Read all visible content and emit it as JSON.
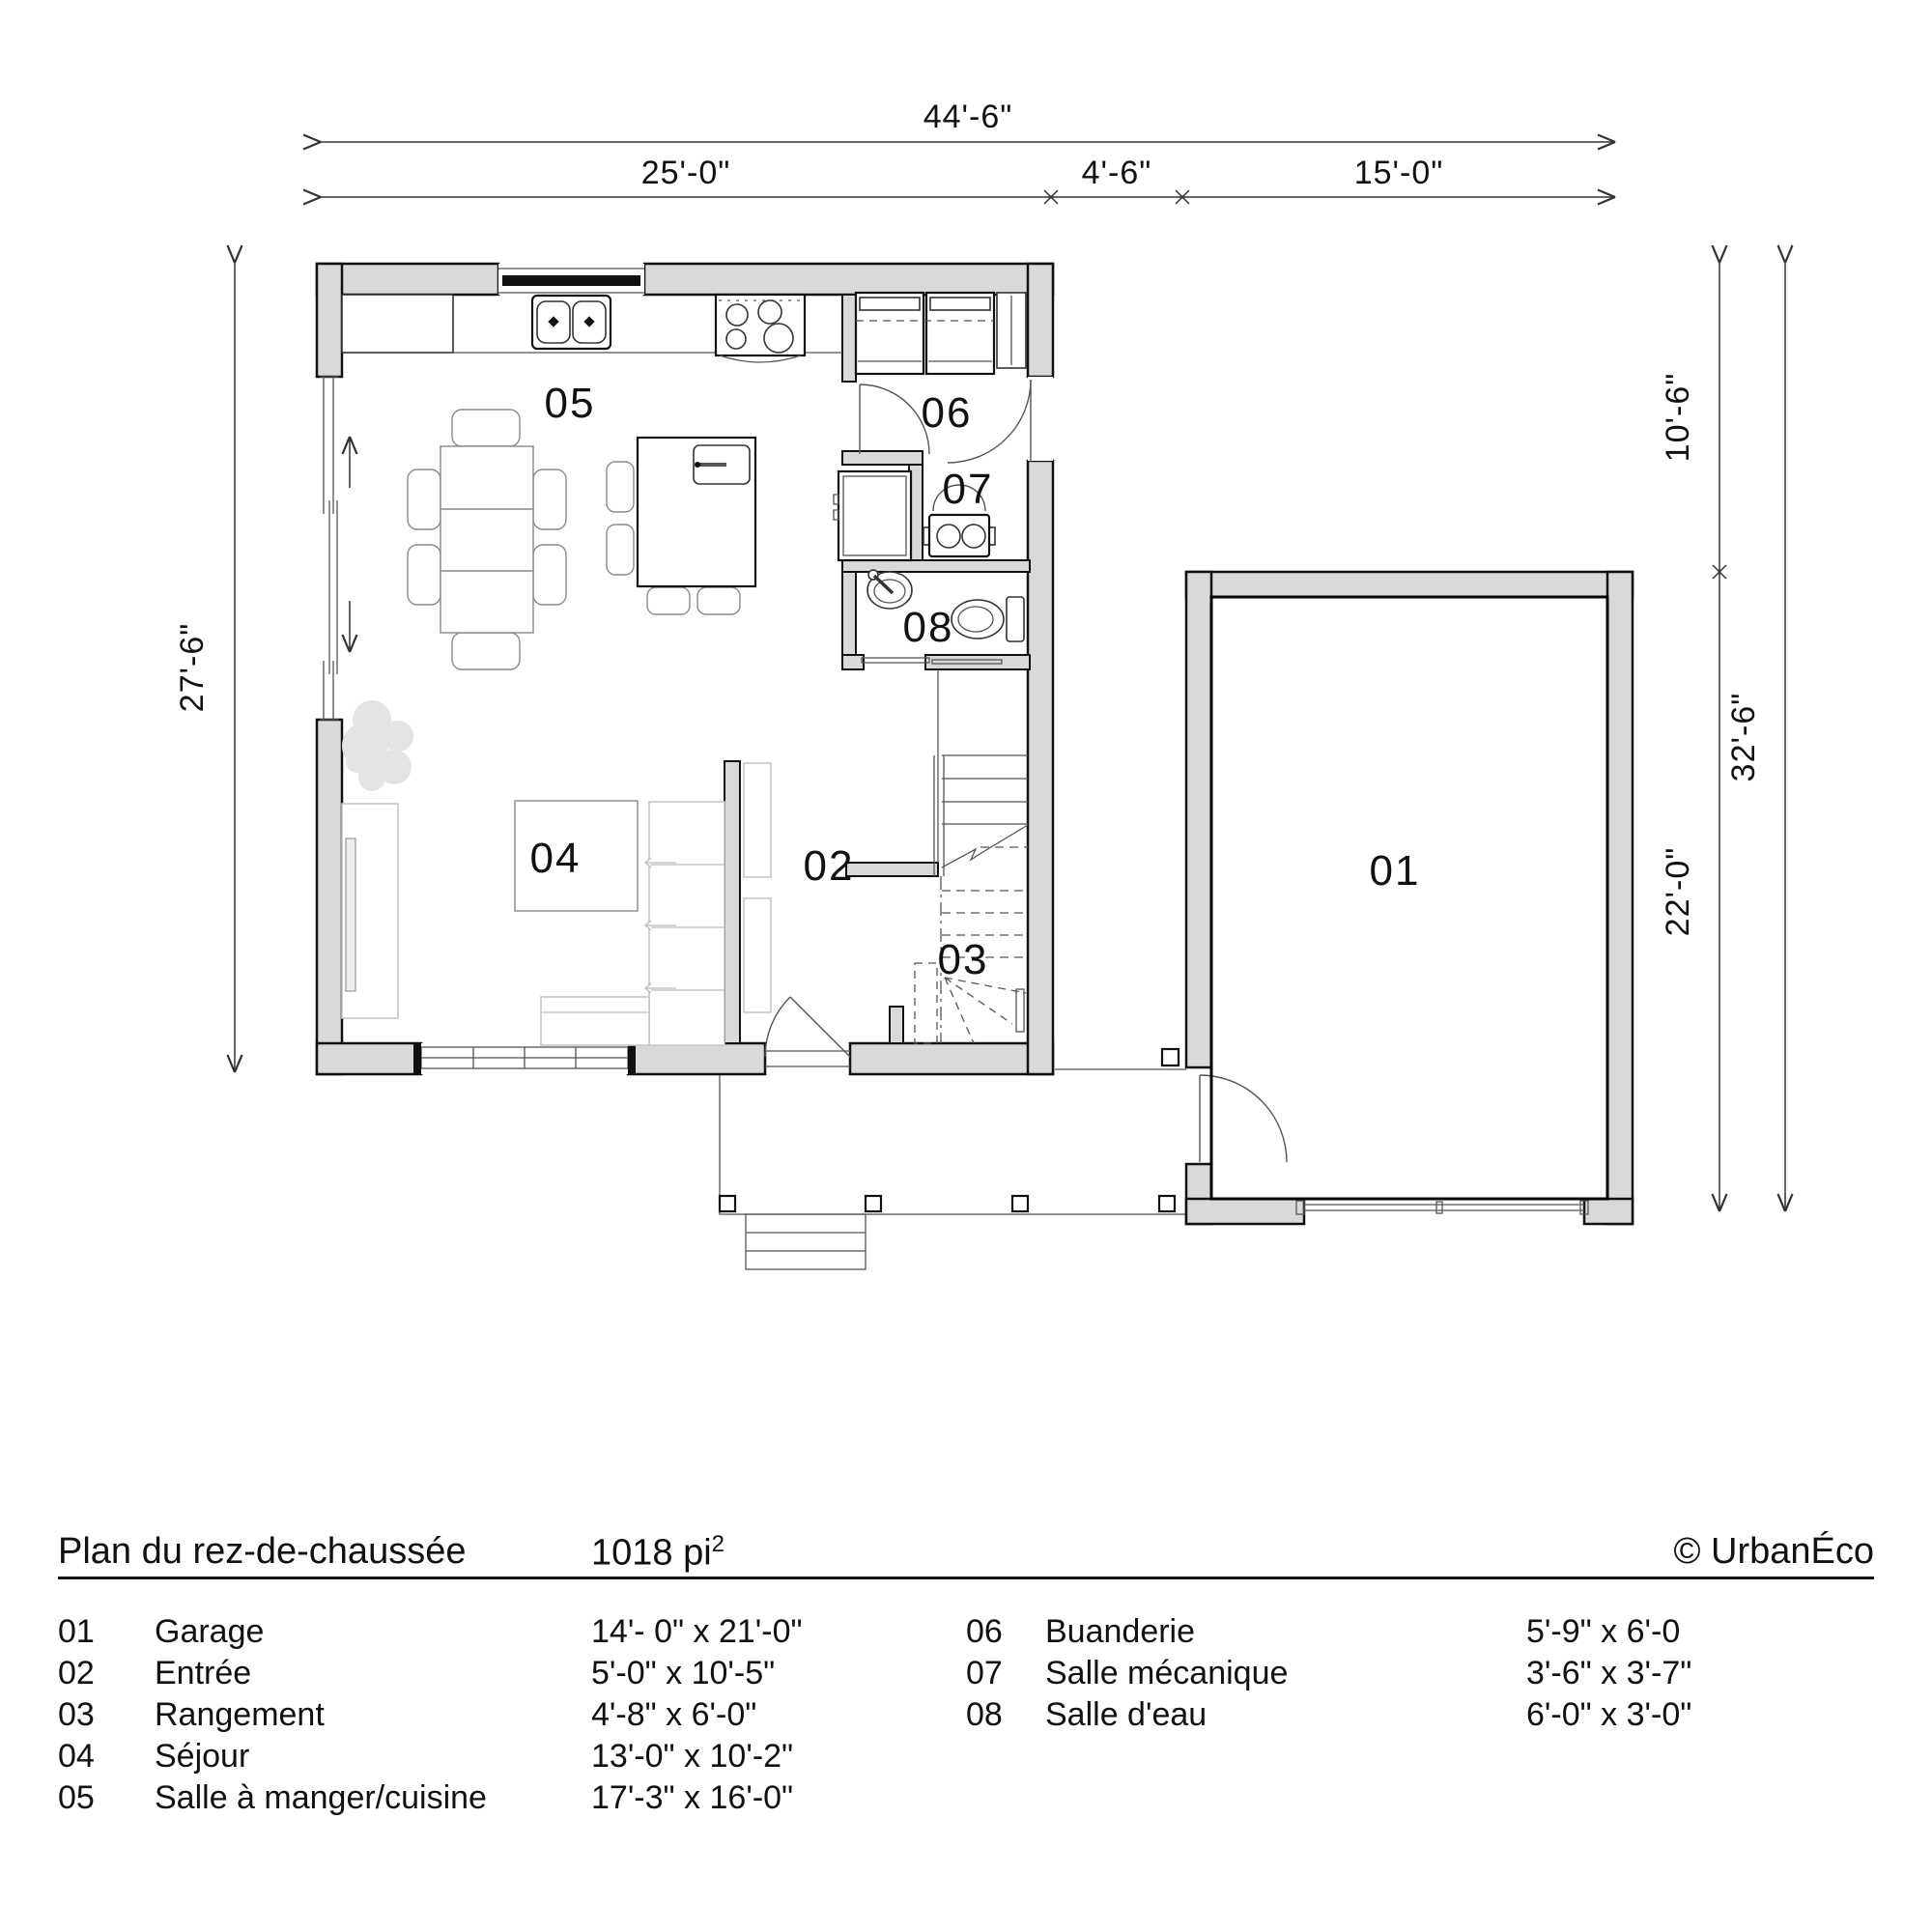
{
  "dimensions": {
    "top_total": "44'-6\"",
    "top_segments": [
      "25'-0\"",
      "4'-6\"",
      "15'-0\""
    ],
    "left_total": "27'-6\"",
    "right_upper": "10'-6\"",
    "right_total": "32'-6\"",
    "right_lower": "22'-0\""
  },
  "rooms": {
    "r01": "01",
    "r02": "02",
    "r03": "03",
    "r04": "04",
    "r05": "05",
    "r06": "06",
    "r07": "07",
    "r08": "08"
  },
  "footer": {
    "title": "Plan du rez-de-chaussée",
    "area_value": "1018 pi",
    "area_exponent": "2",
    "copyright": "© UrbanÉco"
  },
  "legend": {
    "left": [
      {
        "num": "01",
        "name": "Garage",
        "size": "14'- 0\" x 21'-0\""
      },
      {
        "num": "02",
        "name": "Entrée",
        "size": "5'-0\" x 10'-5\""
      },
      {
        "num": "03",
        "name": "Rangement",
        "size": "4'-8\" x 6'-0\""
      },
      {
        "num": "04",
        "name": "Séjour",
        "size": "13'-0\" x 10'-2\""
      },
      {
        "num": "05",
        "name": "Salle à manger/cuisine",
        "size": "17'-3\" x 16'-0\""
      }
    ],
    "right": [
      {
        "num": "06",
        "name": "Buanderie",
        "size": "5'-9\" x 6'-0"
      },
      {
        "num": "07",
        "name": "Salle mécanique",
        "size": "3'-6\" x 3'-7\""
      },
      {
        "num": "08",
        "name": "Salle d'eau",
        "size": "6'-0\" x 3'-0\""
      }
    ]
  }
}
